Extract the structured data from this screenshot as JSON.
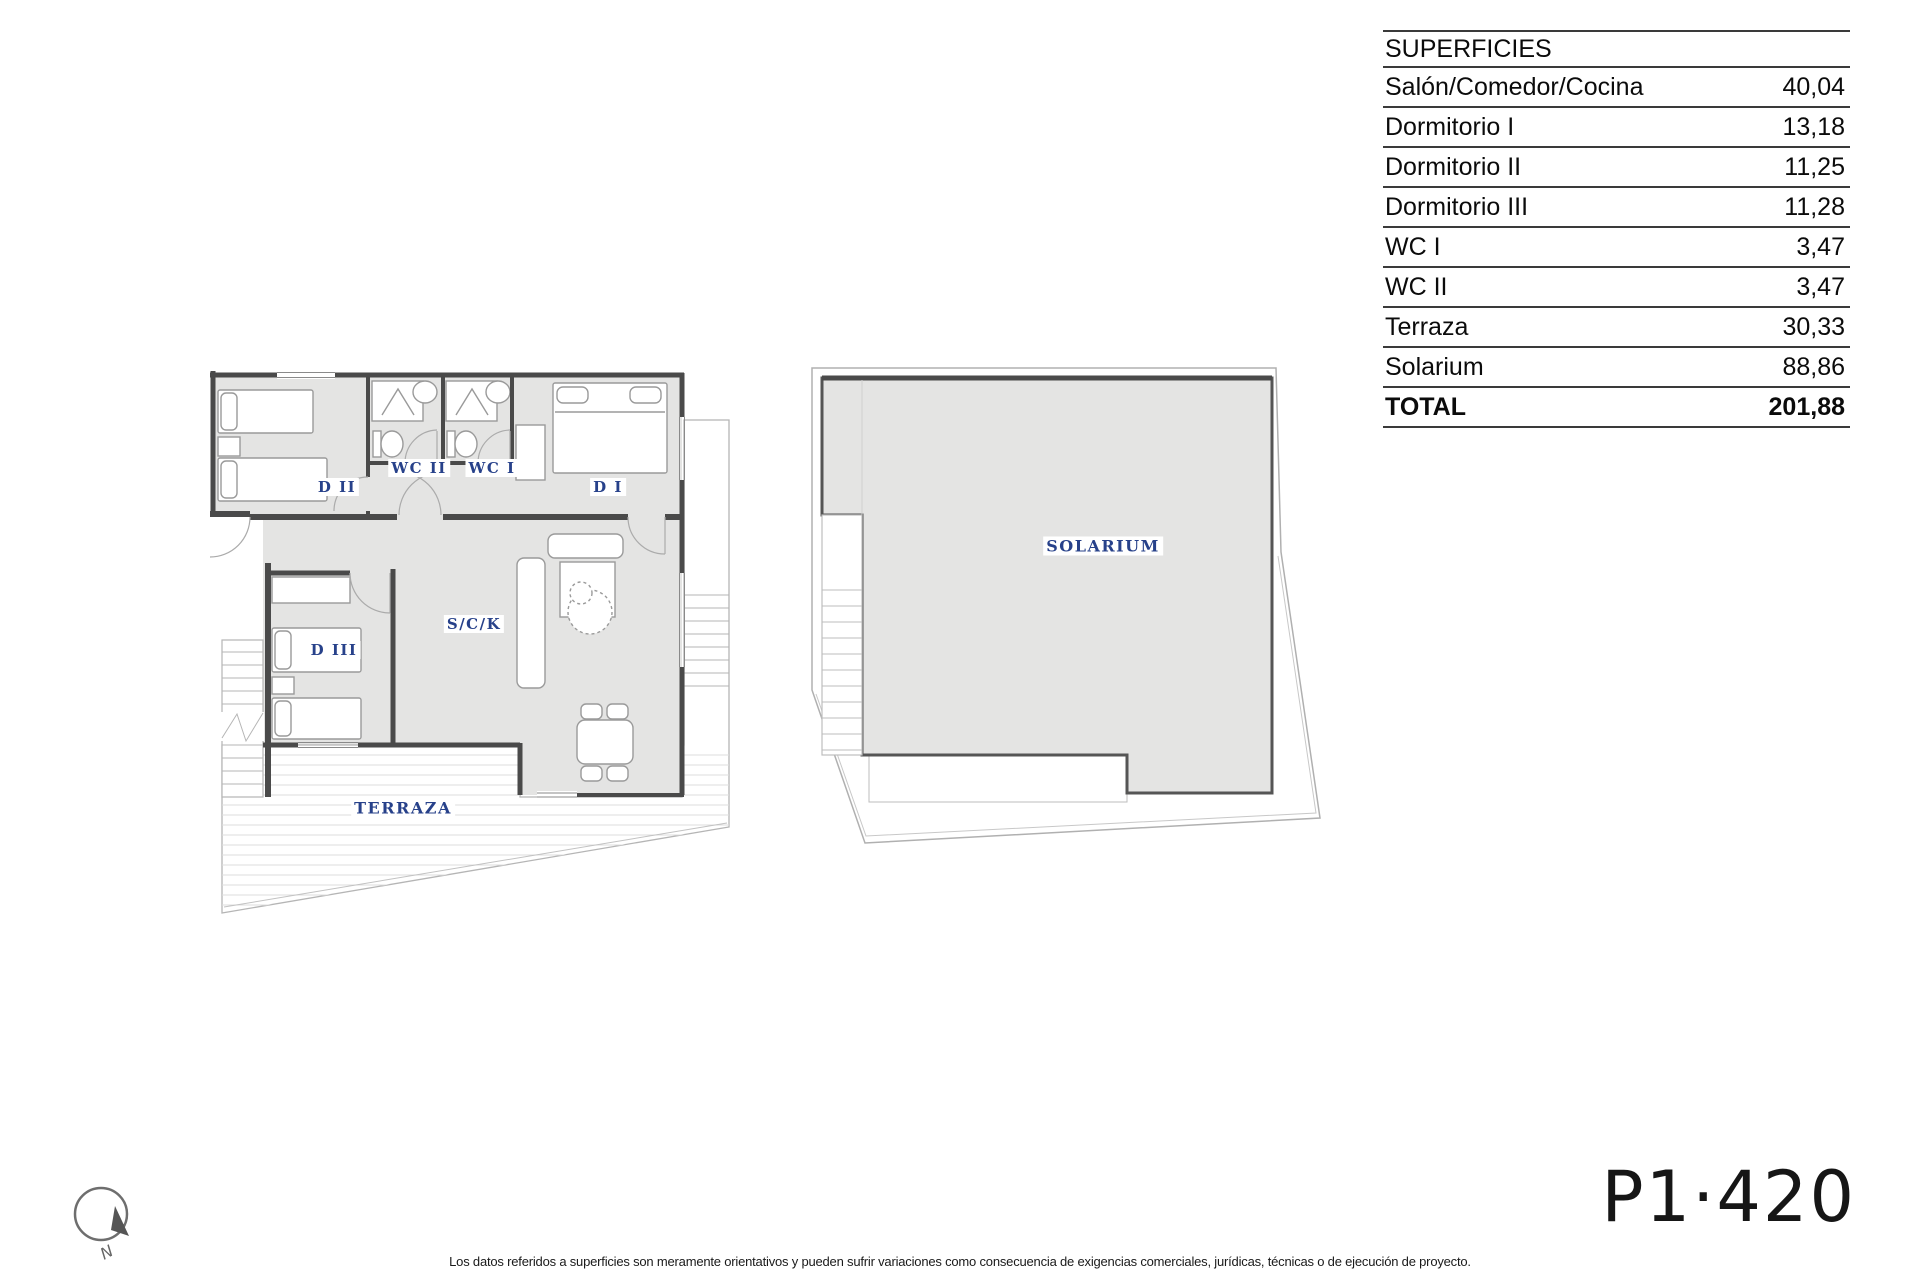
{
  "table": {
    "header": "SUPERFICIES",
    "rows": [
      {
        "label": "Salón/Comedor/Cocina",
        "value": "40,04"
      },
      {
        "label": "Dormitorio I",
        "value": "13,18"
      },
      {
        "label": "Dormitorio II",
        "value": "11,25"
      },
      {
        "label": "Dormitorio III",
        "value": "11,28"
      },
      {
        "label": "WC I",
        "value": "3,47"
      },
      {
        "label": "WC II",
        "value": "3,47"
      },
      {
        "label": "Terraza",
        "value": "30,33"
      },
      {
        "label": "Solarium",
        "value": "88,86"
      },
      {
        "label": "TOTAL",
        "value": "201,88"
      }
    ]
  },
  "apartment_plan": {
    "labels": {
      "dormitorio_2": "D II",
      "wc_2": "WC II",
      "wc_1": "WC I",
      "dormitorio_1": "D I",
      "dormitorio_3": "D III",
      "salon_comedor_cocina": "S/C/K",
      "terraza": "TERRAZA"
    }
  },
  "solarium_plan": {
    "label": "SOLARIUM"
  },
  "compass": {
    "north_label": "N"
  },
  "plate_code": "P1·420",
  "disclaimer": "Los datos referidos a superficies son meramente orientativos y pueden sufrir variaciones como consecuencia de exigencias comerciales, jurídicas, técnicas o de ejecución de proyecto.",
  "colors": {
    "room_fill": "#e4e4e3",
    "wall": "#4a4a4a",
    "label_text": "#27418a"
  }
}
